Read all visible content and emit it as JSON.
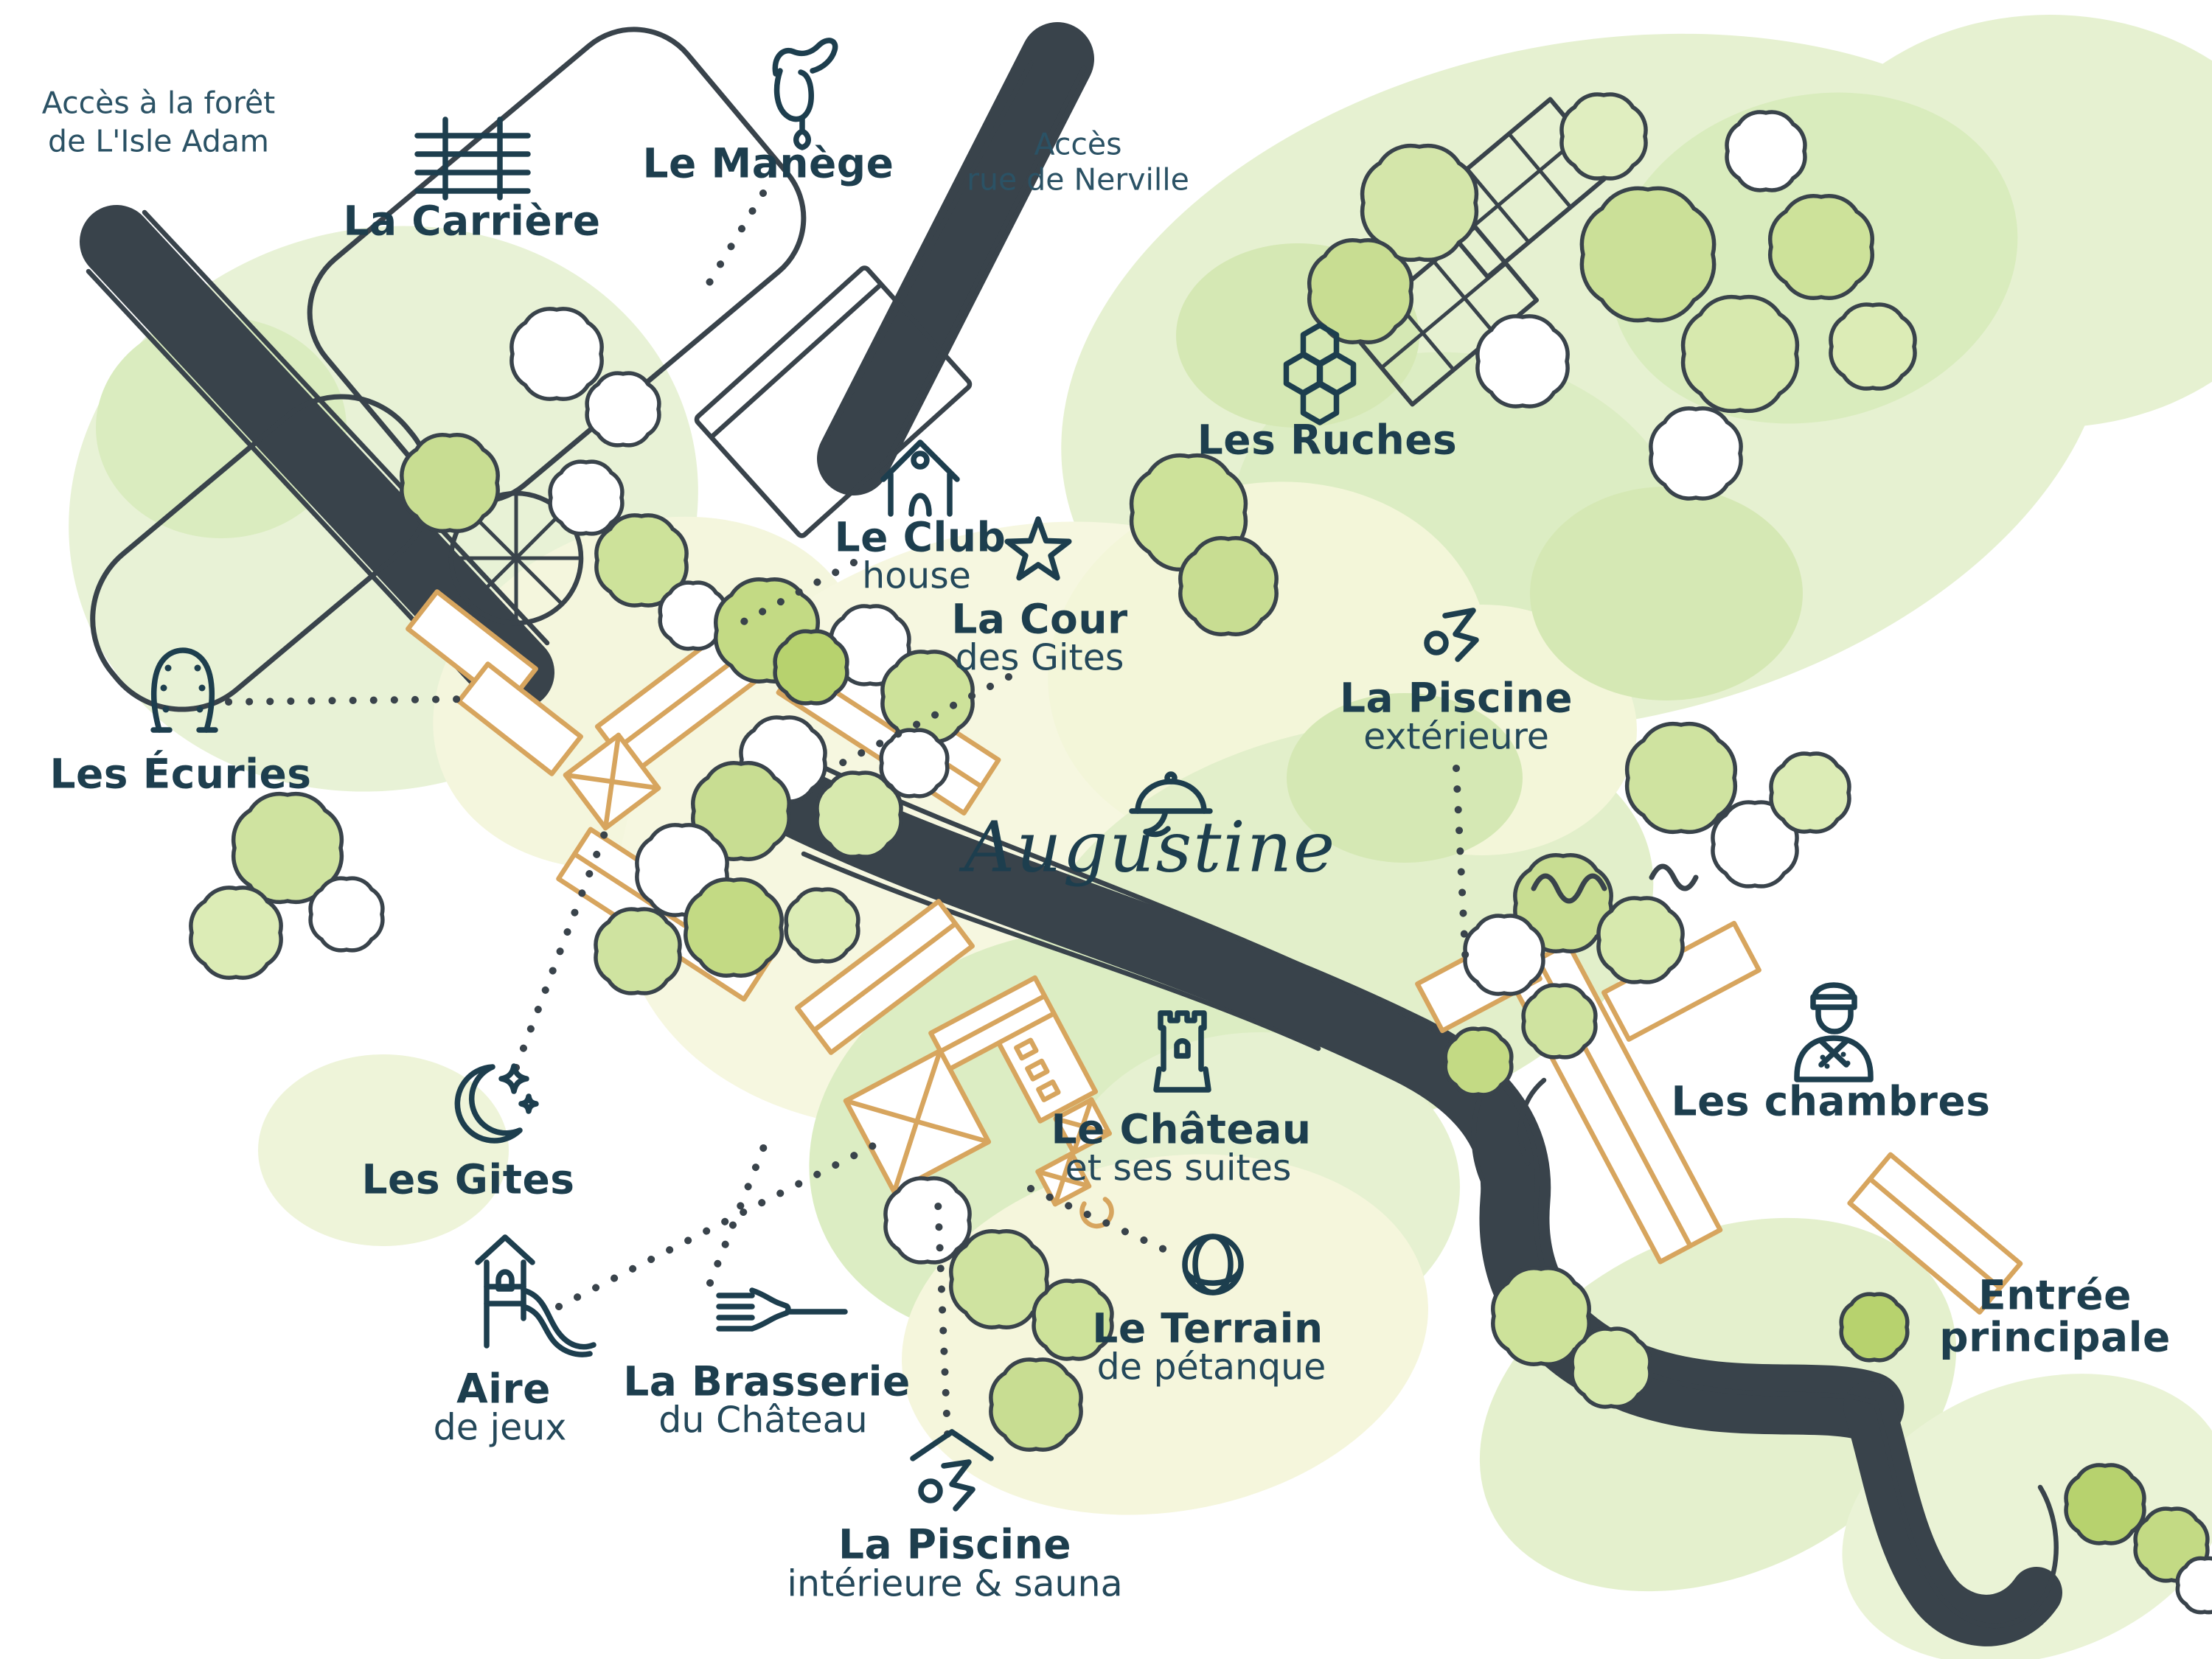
{
  "map": {
    "logo": {
      "name": "Augustine"
    },
    "colors": {
      "text": "#1d3e4e",
      "sketch_ink": "#39434b",
      "building_outline": "#d7a55e",
      "tree_green_bright": "#b7d26e",
      "tree_green_mid": "#cfe3a0",
      "ground_green": "#e6f1d1",
      "ground_pale_yellow": "#f5f6dc"
    },
    "labels": {
      "forest_access": {
        "line1": "Accès à la forêt",
        "line2": "de L'Isle Adam"
      },
      "carriere": {
        "title": "La Carrière"
      },
      "manege": {
        "title": "Le Manège"
      },
      "nerville_access": {
        "line1": "Accès",
        "line2": "rue de Nerville"
      },
      "ruches": {
        "title": "Les Ruches"
      },
      "club_house": {
        "title": "Le Club",
        "subtitle": "house"
      },
      "cour_gites": {
        "title": "La Cour",
        "subtitle": "des Gites"
      },
      "piscine_exterieure": {
        "title": "La Piscine",
        "subtitle": "extérieure"
      },
      "ecuries": {
        "title": "Les Écuries"
      },
      "gites": {
        "title": "Les Gites"
      },
      "chateau": {
        "title": "Le Château",
        "subtitle": "et ses suites"
      },
      "chambres": {
        "title": "Les chambres"
      },
      "aire_de_jeux": {
        "title": "Aire",
        "subtitle": "de jeux"
      },
      "brasserie": {
        "title": "La Brasserie",
        "subtitle": "du Château"
      },
      "terrain_petanque": {
        "title": "Le Terrain",
        "subtitle": "de pétanque"
      },
      "piscine_interieure": {
        "title": "La Piscine",
        "subtitle": "intérieure & sauna"
      },
      "entree_principale": {
        "line1": "Entrée",
        "line2": "principale"
      }
    }
  }
}
